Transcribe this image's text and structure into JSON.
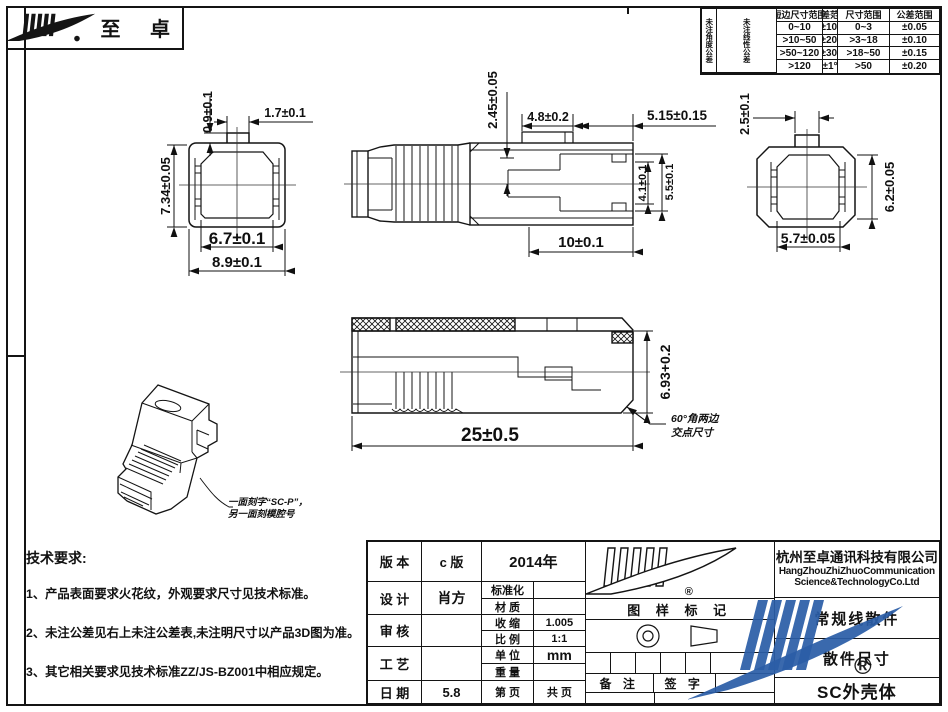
{
  "logo": {
    "brand": "至 卓",
    "registered_mark": "®"
  },
  "tolerance_table": {
    "angle_group": {
      "side_label": "未注角度公差",
      "col_size": "短边尺寸范围",
      "col_tol": "公差范围",
      "rows": [
        {
          "size": "0~10",
          "tol": "±10′"
        },
        {
          "size": ">10~50",
          "tol": "±20′"
        },
        {
          "size": ">50~120",
          "tol": "±30′"
        },
        {
          "size": ">120",
          "tol": "±1°"
        }
      ]
    },
    "linear_group": {
      "side_label": "未注线性公差",
      "col_size": "尺寸范围",
      "col_tol": "公差范围",
      "rows": [
        {
          "size": "0~3",
          "tol": "±0.05"
        },
        {
          "size": ">3~18",
          "tol": "±0.10"
        },
        {
          "size": ">18~50",
          "tol": "±0.15"
        },
        {
          "size": ">50",
          "tol": "±0.20"
        }
      ]
    }
  },
  "dims": {
    "front": {
      "tab_h": "0.9±0.1",
      "tab_w": "1.7±0.1",
      "height": "7.34±0.05",
      "inner_w": "6.7±0.1",
      "outer_w": "8.9±0.1"
    },
    "side": {
      "key_h": "2.45±0.05",
      "tab_len": "4.8±0.2",
      "nose_len": "5.15±0.15",
      "slot_h": "4.1±0.1",
      "window_h": "5.5±0.1",
      "body_len": "10±0.1"
    },
    "rear": {
      "tab_w": "2.5±0.1",
      "height": "6.2±0.05",
      "width": "5.7±0.05"
    },
    "profile": {
      "length": "25±0.5",
      "height": "6.93+0.2"
    }
  },
  "notes": {
    "angle_line1": "60°角两边",
    "angle_line2": "交点尺寸",
    "engrave_line1": "一面刻字“SC-P”，",
    "engrave_line2": "另一面刻模腔号"
  },
  "tech_requirements": {
    "title": "技术要求:",
    "items": [
      "1、产品表面要求火花纹，外观要求尺寸见技术标准。",
      "2、未注公差见右上未注公差表,未注明尺寸以产品3D图为准。",
      "3、其它相关要求见技术标准ZZ/JS-BZ001中相应规定。"
    ]
  },
  "title_block": {
    "version_label": "版 本",
    "version_value": "c 版",
    "year": "2014年",
    "design_label": "设 计",
    "design_value": "肖方",
    "review_label": "审 核",
    "review_value": "",
    "process_label": "工 艺",
    "process_value": "",
    "date_label": "日 期",
    "date_value": "5.8",
    "standardization_label": "标准化",
    "standardization_value": "",
    "material_label": "材 质",
    "material_value": "",
    "shrink_label": "收 缩",
    "shrink_value": "1.005",
    "scale_label": "比 例",
    "scale_value": "1:1",
    "unit_label": "单 位",
    "unit_value": "mm",
    "weight_label": "重 量",
    "weight_value": "",
    "page_label": "第 页",
    "pages_label": "共 页",
    "drawing_mark_label": "图 样 标 记",
    "remark_label": "备 注",
    "sign_label": "签 字",
    "company_cn": "杭州至卓通讯科技有限公司",
    "company_en1": "HangZhouZhiZhuoCommunication",
    "company_en2": "Science&TechnologyCo.Ltd",
    "product_line": "常规线散件",
    "doc_type": "散件尺寸",
    "part_name": "SC外壳体",
    "registered_mark": "®"
  }
}
